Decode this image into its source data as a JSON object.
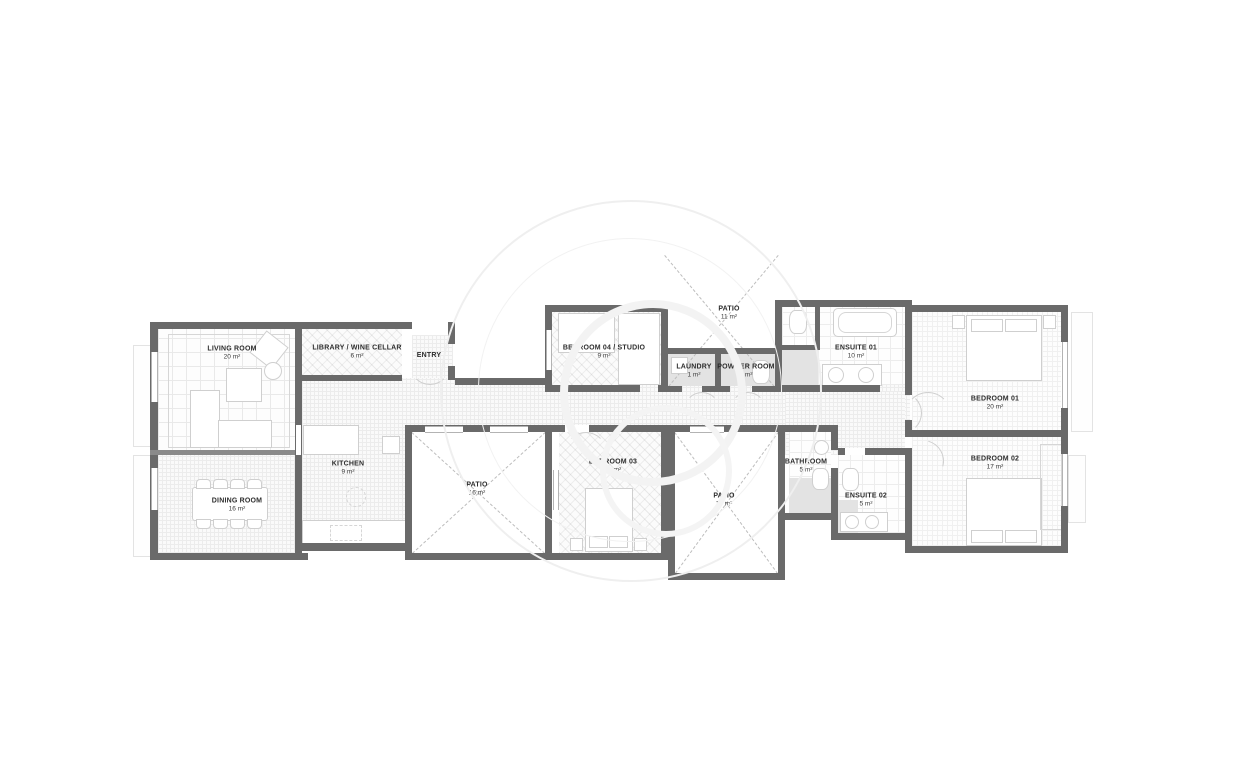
{
  "plan": {
    "type": "apartment-floor-plan",
    "rooms": [
      {
        "id": "living-room",
        "label": "LIVING ROOM",
        "area": "20 m²"
      },
      {
        "id": "dining-room",
        "label": "DINING ROOM",
        "area": "16 m²"
      },
      {
        "id": "library-wine-cellar",
        "label": "LIBRARY / WINE CELLAR",
        "area": "6 m²"
      },
      {
        "id": "entry",
        "label": "ENTRY",
        "area": ""
      },
      {
        "id": "kitchen",
        "label": "KITCHEN",
        "area": "9 m²"
      },
      {
        "id": "bedroom-04-studio",
        "label": "BEDROOM 04 / STUDIO",
        "area": "9 m²"
      },
      {
        "id": "patio-top",
        "label": "PATIO",
        "area": "11 m²"
      },
      {
        "id": "laundry",
        "label": "LAUNDRY",
        "area": "1 m²"
      },
      {
        "id": "powder-room",
        "label": "POWDER ROOM",
        "area": "2 m²"
      },
      {
        "id": "ensuite-01",
        "label": "ENSUITE 01",
        "area": "10 m²"
      },
      {
        "id": "bedroom-01",
        "label": "BEDROOM 01",
        "area": "20 m²"
      },
      {
        "id": "patio-left",
        "label": "PATIO",
        "area": "16 m²"
      },
      {
        "id": "bedroom-03",
        "label": "BEDROOM 03",
        "area": "16 m²"
      },
      {
        "id": "patio-right",
        "label": "PATIO",
        "area": "17 m²"
      },
      {
        "id": "bathroom",
        "label": "BATHROOM",
        "area": "5 m²"
      },
      {
        "id": "ensuite-02",
        "label": "ENSUITE 02",
        "area": "5 m²"
      },
      {
        "id": "bedroom-02",
        "label": "BEDROOM 02",
        "area": "17 m²"
      }
    ],
    "colors": {
      "wall": "#6a6a6a",
      "label_text": "#2d2d2d",
      "floor_line": "#ececec",
      "furniture_line": "#cfcfcf",
      "patio_dash": "#bdbdbd",
      "watermark": "#eeeeee"
    }
  }
}
